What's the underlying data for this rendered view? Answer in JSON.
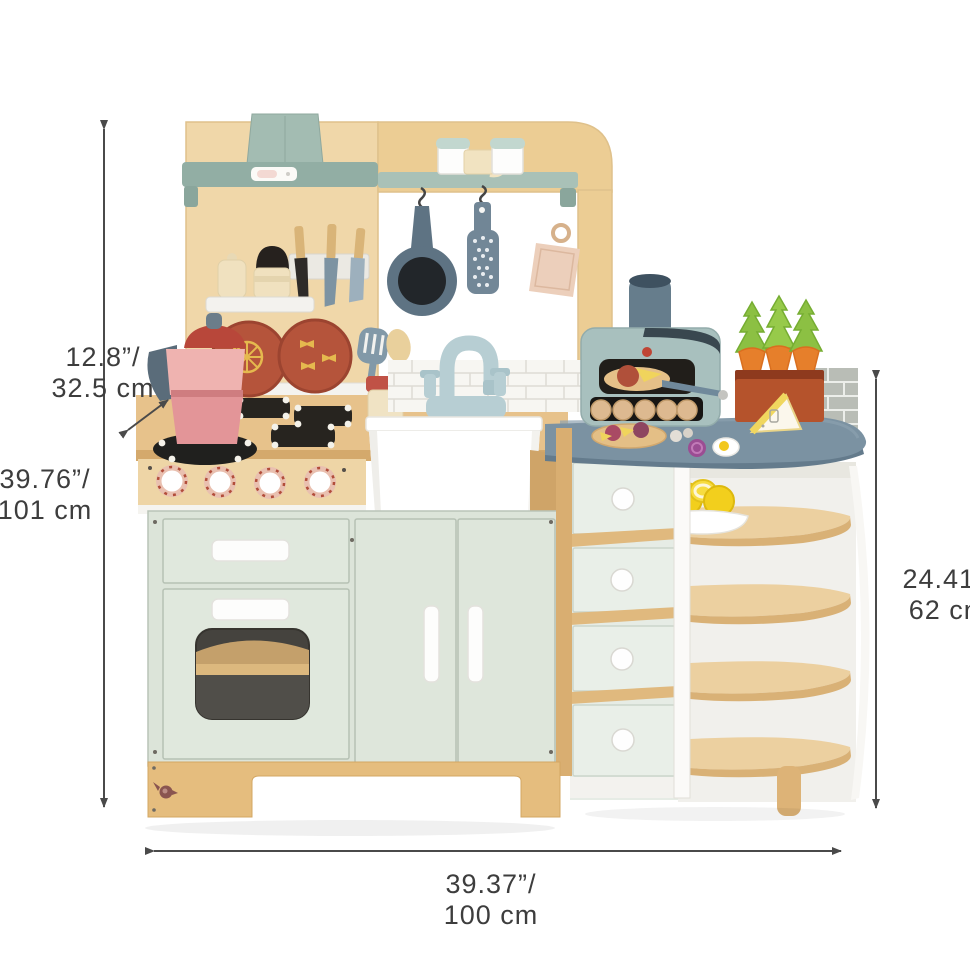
{
  "figure": {
    "type": "product dimension illustration",
    "subject": "wooden toy play kitchen with hood, stove, sink, pizza oven, drawers and curved corner shelves"
  },
  "dimension_labels": {
    "depth": {
      "inches": "12.8”/",
      "metric": "32.5 cm"
    },
    "overall_height": {
      "inches": "39.76”/",
      "metric": "101 cm"
    },
    "side_height": {
      "inches": "24.41”/",
      "metric": "62 cm"
    },
    "width": {
      "inches": "39.37”/",
      "metric": "100 cm"
    }
  },
  "palette": {
    "wood_light": "#f0d7a9",
    "wood_mid": "#e7c28b",
    "wood_dark": "#d4a96c",
    "mint_panel": "#dfe7dc",
    "sage_hood": "#9cb6ac",
    "slate_blue": "#5e7383",
    "counter_blue": "#7b92a2",
    "faucet_blue": "#b7ced3",
    "terracotta": "#b5543b",
    "moka_pink": "#efb3b0",
    "carrot_orange": "#e67f2b",
    "carrot_green": "#8cc043",
    "lemon_yellow": "#f2cf1d",
    "dimension_line": "#4a4a4a",
    "label_text": "#3d3d3d"
  }
}
